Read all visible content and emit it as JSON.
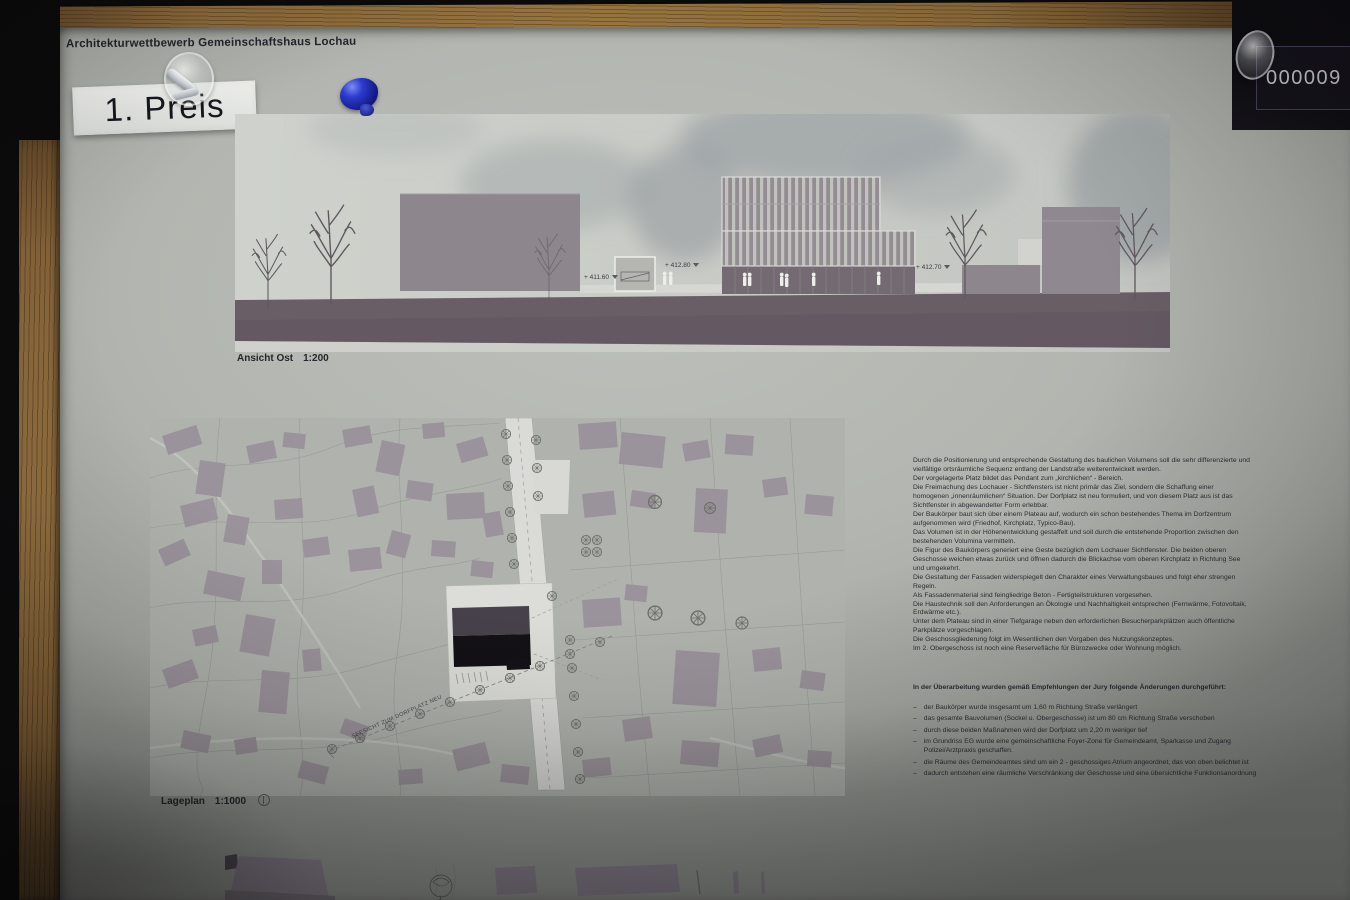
{
  "photo": {
    "id_stamp": "000009 II",
    "colors": {
      "wood_frame": "#8d6b3c",
      "poster_paper": "#b3b6b0",
      "elevation_ground": "#695e66",
      "building_grey": "#9b939b",
      "new_building_black": "#141215",
      "road_white": "#dadbd7",
      "pushpin_blue": "#2d3bd0",
      "stamp_background": "#15131a"
    }
  },
  "poster": {
    "title": "Architekturwettbewerb Gemeinschaftshaus Lochau",
    "award_label": "1. Preis",
    "elevation": {
      "caption": "Ansicht Ost",
      "scale": "1:200",
      "levels": [
        "+ 411.60",
        "+ 412.80",
        "+ 412.70"
      ]
    },
    "siteplan": {
      "caption": "Lageplan",
      "scale": "1:1000",
      "annotation": "SEESICHT ZUM DORFPLATZ NEU"
    },
    "description": {
      "paragraphs": [
        "Durch die Positionierung und entsprechende Gestaltung des baulichen Volumens soll die sehr differenzierte und vielfältige ortsräumliche Sequenz entlang der Landstraße weiterentwickelt werden.",
        "Der vorgelagerte Platz bildet das Pendant zum „kirchlichen“ - Bereich.",
        "Die Freimachung des Lochauer - Sichtfensters ist nicht primär das Ziel, sondern die Schaffung einer homogenen „innenräumlichen“ Situation. Der Dorfplatz ist neu formuliert, und von diesem Platz aus ist das Sichtfenster in abgewandelter Form erlebbar.",
        "Der Baukörper baut sich über einem Plateau auf, wodurch ein schon bestehendes Thema im Dorfzentrum aufgenommen wird (Friedhof, Kirchplatz, Typico-Bau).",
        "Das Volumen ist in der Höhenentwicklung gestaffelt und soll durch die entstehende Proportion zwischen den bestehenden Volumina vermitteln.",
        "Die Figur des Baukörpers generiert eine Geste bezüglich dem Lochauer Sichtfenster. Die beiden oberen Geschosse weichen etwas zurück und öffnen dadurch die Blickachse vom oberen Kirchplatz in Richtung See und umgekehrt.",
        "Die Gestaltung der Fassaden widerspiegelt den Charakter eines Verwaltungsbaues und folgt eher strengen Regeln.",
        "Als Fassadenmaterial sind feingliedrige Beton - Fertigteilstrukturen vorgesehen.",
        "Die Haustechnik soll den Anforderungen an Ökologie und Nachhaltigkeit entsprechen (Fernwärme, Fotovoltaik, Erdwärme etc.).",
        "Unter dem Plateau sind in einer Tiefgarage neben den erforderlichen Besucherparkplätzen auch öffentliche Parkplätze vorgeschlagen.",
        "Die Geschossgliederung folgt im Wesentlichen den Vorgaben des Nutzungskonzeptes.",
        "Im  2. Obergeschoss ist  noch eine Reservefläche für Bürozwecke oder Wohnung möglich."
      ]
    },
    "revisions": {
      "heading": "In der Überarbeitung wurden gemäß Empfehlungen der Jury folgende Änderungen durchgeführt:",
      "bullet": "–",
      "items": [
        "der Baukörper wurde insgesamt um 1,60 m Richtung Straße verlängert",
        "das gesamte Bauvolumen (Sockel u. Obergeschosse) ist um 80 cm Richtung Straße verschoben",
        "durch diese beiden Maßnahmen wird der Dorfplatz um 2,20 m weniger tief",
        "im Grundriss EG wurde eine gemeinschaftliche Foyer-Zone für Gemeindeamt, Sparkasse und Zugang Polizei/Arztpraxis geschaffen.",
        "die Räume des Gemeindeamtes sind um ein 2 - geschossiges Atrium angeordnet, das von oben belichtet ist",
        "dadurch entstehen eine räumliche Verschränkung der Geschosse und eine übersichtliche Funktionsanordnung"
      ]
    }
  }
}
